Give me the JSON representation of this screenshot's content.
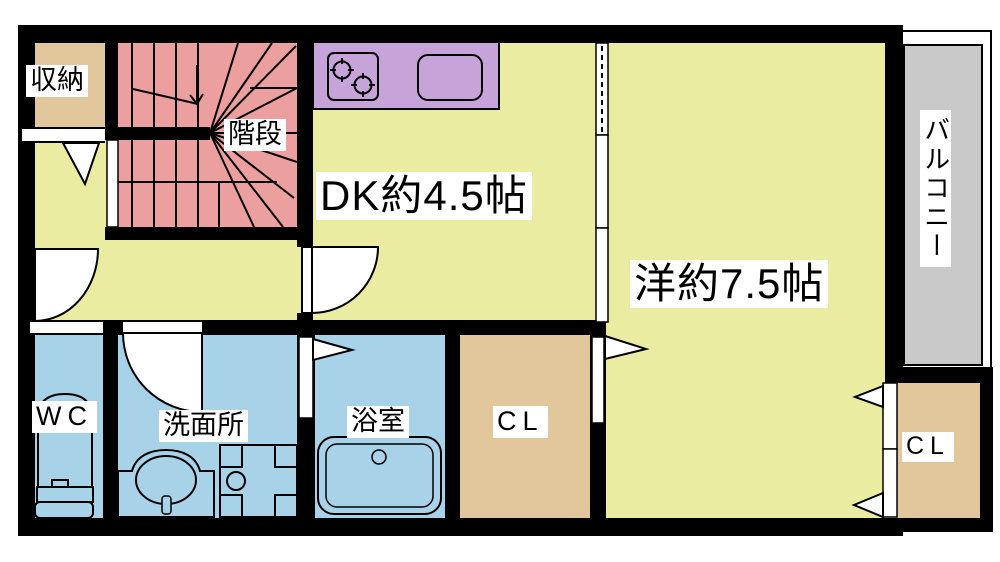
{
  "floorplan": {
    "rooms": [
      {
        "name": "storage",
        "label": "収納"
      },
      {
        "name": "stairs",
        "label": "階段"
      },
      {
        "name": "dining-kitchen",
        "label": "DK約4.5帖"
      },
      {
        "name": "western-room",
        "label": "洋約7.5帖"
      },
      {
        "name": "balcony",
        "label": "バルコニー"
      },
      {
        "name": "toilet-room",
        "label": "WC"
      },
      {
        "name": "washroom",
        "label": "洗面所"
      },
      {
        "name": "bathroom",
        "label": "浴室"
      },
      {
        "name": "closet-main",
        "label": "CL"
      },
      {
        "name": "closet-bedroom",
        "label": "CL"
      }
    ],
    "fixtures": [
      "stove",
      "kitchen-sink",
      "toilet",
      "vanity-sink",
      "washing-machine-pan",
      "bathtub",
      "staircase"
    ],
    "colors": {
      "room_yellow": "#eaeca1",
      "stairs_pink": "#ec9f9f",
      "closet_tan": "#e2c69c",
      "kitchen_purple": "#c6a3d8",
      "wet_blue": "#a8d2e8",
      "balcony_gray": "#c9c9c9",
      "wall": "#000000",
      "background": "#ffffff"
    }
  }
}
